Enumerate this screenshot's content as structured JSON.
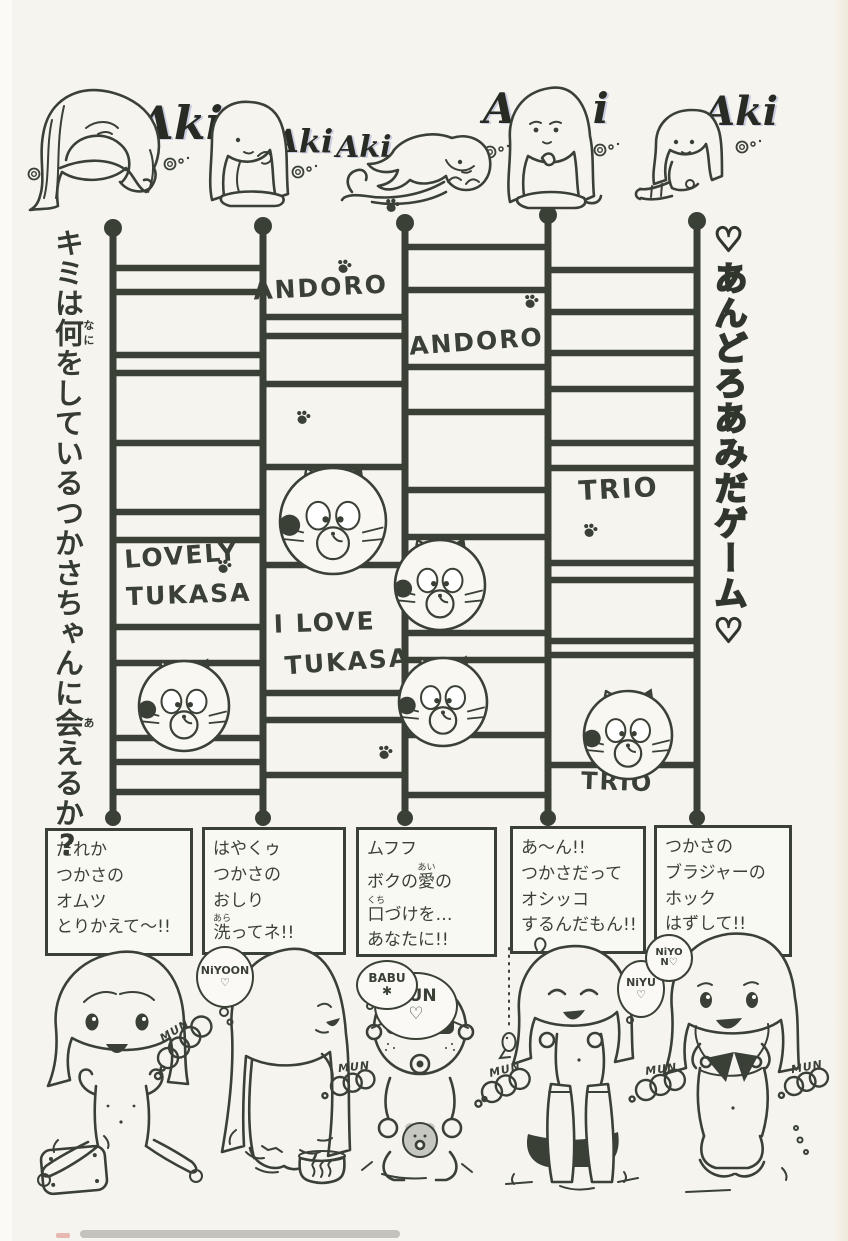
{
  "page": {
    "ink_color": "#3a4036",
    "paper_color": "#f6f4ee"
  },
  "titles": {
    "left_question": "キミは何(なに)をしているつかさちゃんに会(あ)えるか?",
    "right_game": "♡あんどろあみだゲーム♡"
  },
  "signatures": {
    "items": [
      "Aki",
      "Aki",
      "Aki",
      "Aki",
      "Aki"
    ]
  },
  "ladder": {
    "bottom_y": 818,
    "verticals": [
      {
        "x": 113,
        "y1": 228
      },
      {
        "x": 263,
        "y1": 226
      },
      {
        "x": 405,
        "y1": 223
      },
      {
        "x": 548,
        "y1": 215
      },
      {
        "x": 697,
        "y1": 221
      }
    ],
    "rungs": [
      [
        0,
        268
      ],
      [
        0,
        292
      ],
      [
        0,
        355
      ],
      [
        0,
        373
      ],
      [
        0,
        443
      ],
      [
        0,
        512
      ],
      [
        0,
        540
      ],
      [
        0,
        627
      ],
      [
        0,
        663
      ],
      [
        0,
        738
      ],
      [
        0,
        762
      ],
      [
        0,
        792
      ],
      [
        1,
        317
      ],
      [
        1,
        336
      ],
      [
        1,
        384
      ],
      [
        1,
        467
      ],
      [
        1,
        565
      ],
      [
        1,
        693
      ],
      [
        1,
        720
      ],
      [
        1,
        775
      ],
      [
        2,
        247
      ],
      [
        2,
        290
      ],
      [
        2,
        367
      ],
      [
        2,
        412
      ],
      [
        2,
        490
      ],
      [
        2,
        537
      ],
      [
        2,
        633
      ],
      [
        2,
        660
      ],
      [
        2,
        735
      ],
      [
        2,
        795
      ],
      [
        3,
        270
      ],
      [
        3,
        312
      ],
      [
        3,
        353
      ],
      [
        3,
        389
      ],
      [
        3,
        443
      ],
      [
        3,
        468
      ],
      [
        3,
        563
      ],
      [
        3,
        580
      ],
      [
        3,
        641
      ],
      [
        3,
        655
      ],
      [
        3,
        765
      ]
    ],
    "labels": [
      {
        "text": "ANDORO",
        "x": 321,
        "y": 296,
        "size": 25,
        "rot": -3
      },
      {
        "text": "ANDORO",
        "x": 477,
        "y": 350,
        "size": 25,
        "rot": -4
      },
      {
        "text": "TRIO",
        "x": 619,
        "y": 498,
        "size": 27,
        "rot": -3
      },
      {
        "text": "LOVELY",
        "x": 182,
        "y": 564,
        "size": 25,
        "rot": -4
      },
      {
        "text": "TUKASA",
        "x": 189,
        "y": 603,
        "size": 25,
        "rot": -2
      },
      {
        "text": "I LOVE",
        "x": 325,
        "y": 631,
        "size": 25,
        "rot": -2
      },
      {
        "text": "TUKASA",
        "x": 348,
        "y": 670,
        "size": 25,
        "rot": -4
      },
      {
        "text": "TRIO",
        "x": 617,
        "y": 790,
        "size": 24,
        "rot": 2
      }
    ],
    "cats": [
      {
        "x": 333,
        "y": 521,
        "r": 53
      },
      {
        "x": 440,
        "y": 585,
        "r": 45
      },
      {
        "x": 184,
        "y": 706,
        "r": 45
      },
      {
        "x": 443,
        "y": 702,
        "r": 44
      },
      {
        "x": 628,
        "y": 735,
        "r": 44
      }
    ],
    "paws": [
      {
        "x": 344,
        "y": 266
      },
      {
        "x": 531,
        "y": 301
      },
      {
        "x": 303,
        "y": 417
      },
      {
        "x": 590,
        "y": 530
      },
      {
        "x": 224,
        "y": 566
      },
      {
        "x": 385,
        "y": 752
      },
      {
        "x": 392,
        "y": 205
      }
    ],
    "sparkles": [
      {
        "x": 170,
        "y": 164
      },
      {
        "x": 298,
        "y": 172
      },
      {
        "x": 490,
        "y": 152
      },
      {
        "x": 600,
        "y": 150
      },
      {
        "x": 742,
        "y": 147
      },
      {
        "x": 34,
        "y": 174
      }
    ]
  },
  "speech_boxes": [
    {
      "lines": [
        "だれか",
        "つかさの",
        "オムツ",
        "とりかえて〜!!"
      ]
    },
    {
      "lines": [
        "はやくゥ",
        "つかさの",
        "おしり",
        "洗(あら)ってネ!!"
      ]
    },
    {
      "lines": [
        "ムフフ",
        "ボクの愛(あい)の",
        "口(くち)づけを…",
        "あなたに!!"
      ]
    },
    {
      "lines": [
        "あ〜ん!!",
        "つかさだって",
        "オシッコ",
        "するんだもん!!"
      ]
    },
    {
      "lines": [
        "つかさの",
        "ブラジャーの",
        "ホック",
        "はずして!!"
      ]
    }
  ],
  "bubbles": [
    {
      "lines": [
        "RUN",
        "♡"
      ]
    },
    {
      "lines": [
        "NiYOON",
        "♡"
      ]
    },
    {
      "lines": [
        "BABU",
        "✱"
      ]
    },
    {
      "lines": [
        "NiYU",
        "♡"
      ]
    },
    {
      "lines": [
        "NiYO",
        "N♡"
      ]
    }
  ],
  "sound_effects": [
    "MUN",
    "MUN",
    "MUN",
    "MUN",
    "MUN"
  ]
}
